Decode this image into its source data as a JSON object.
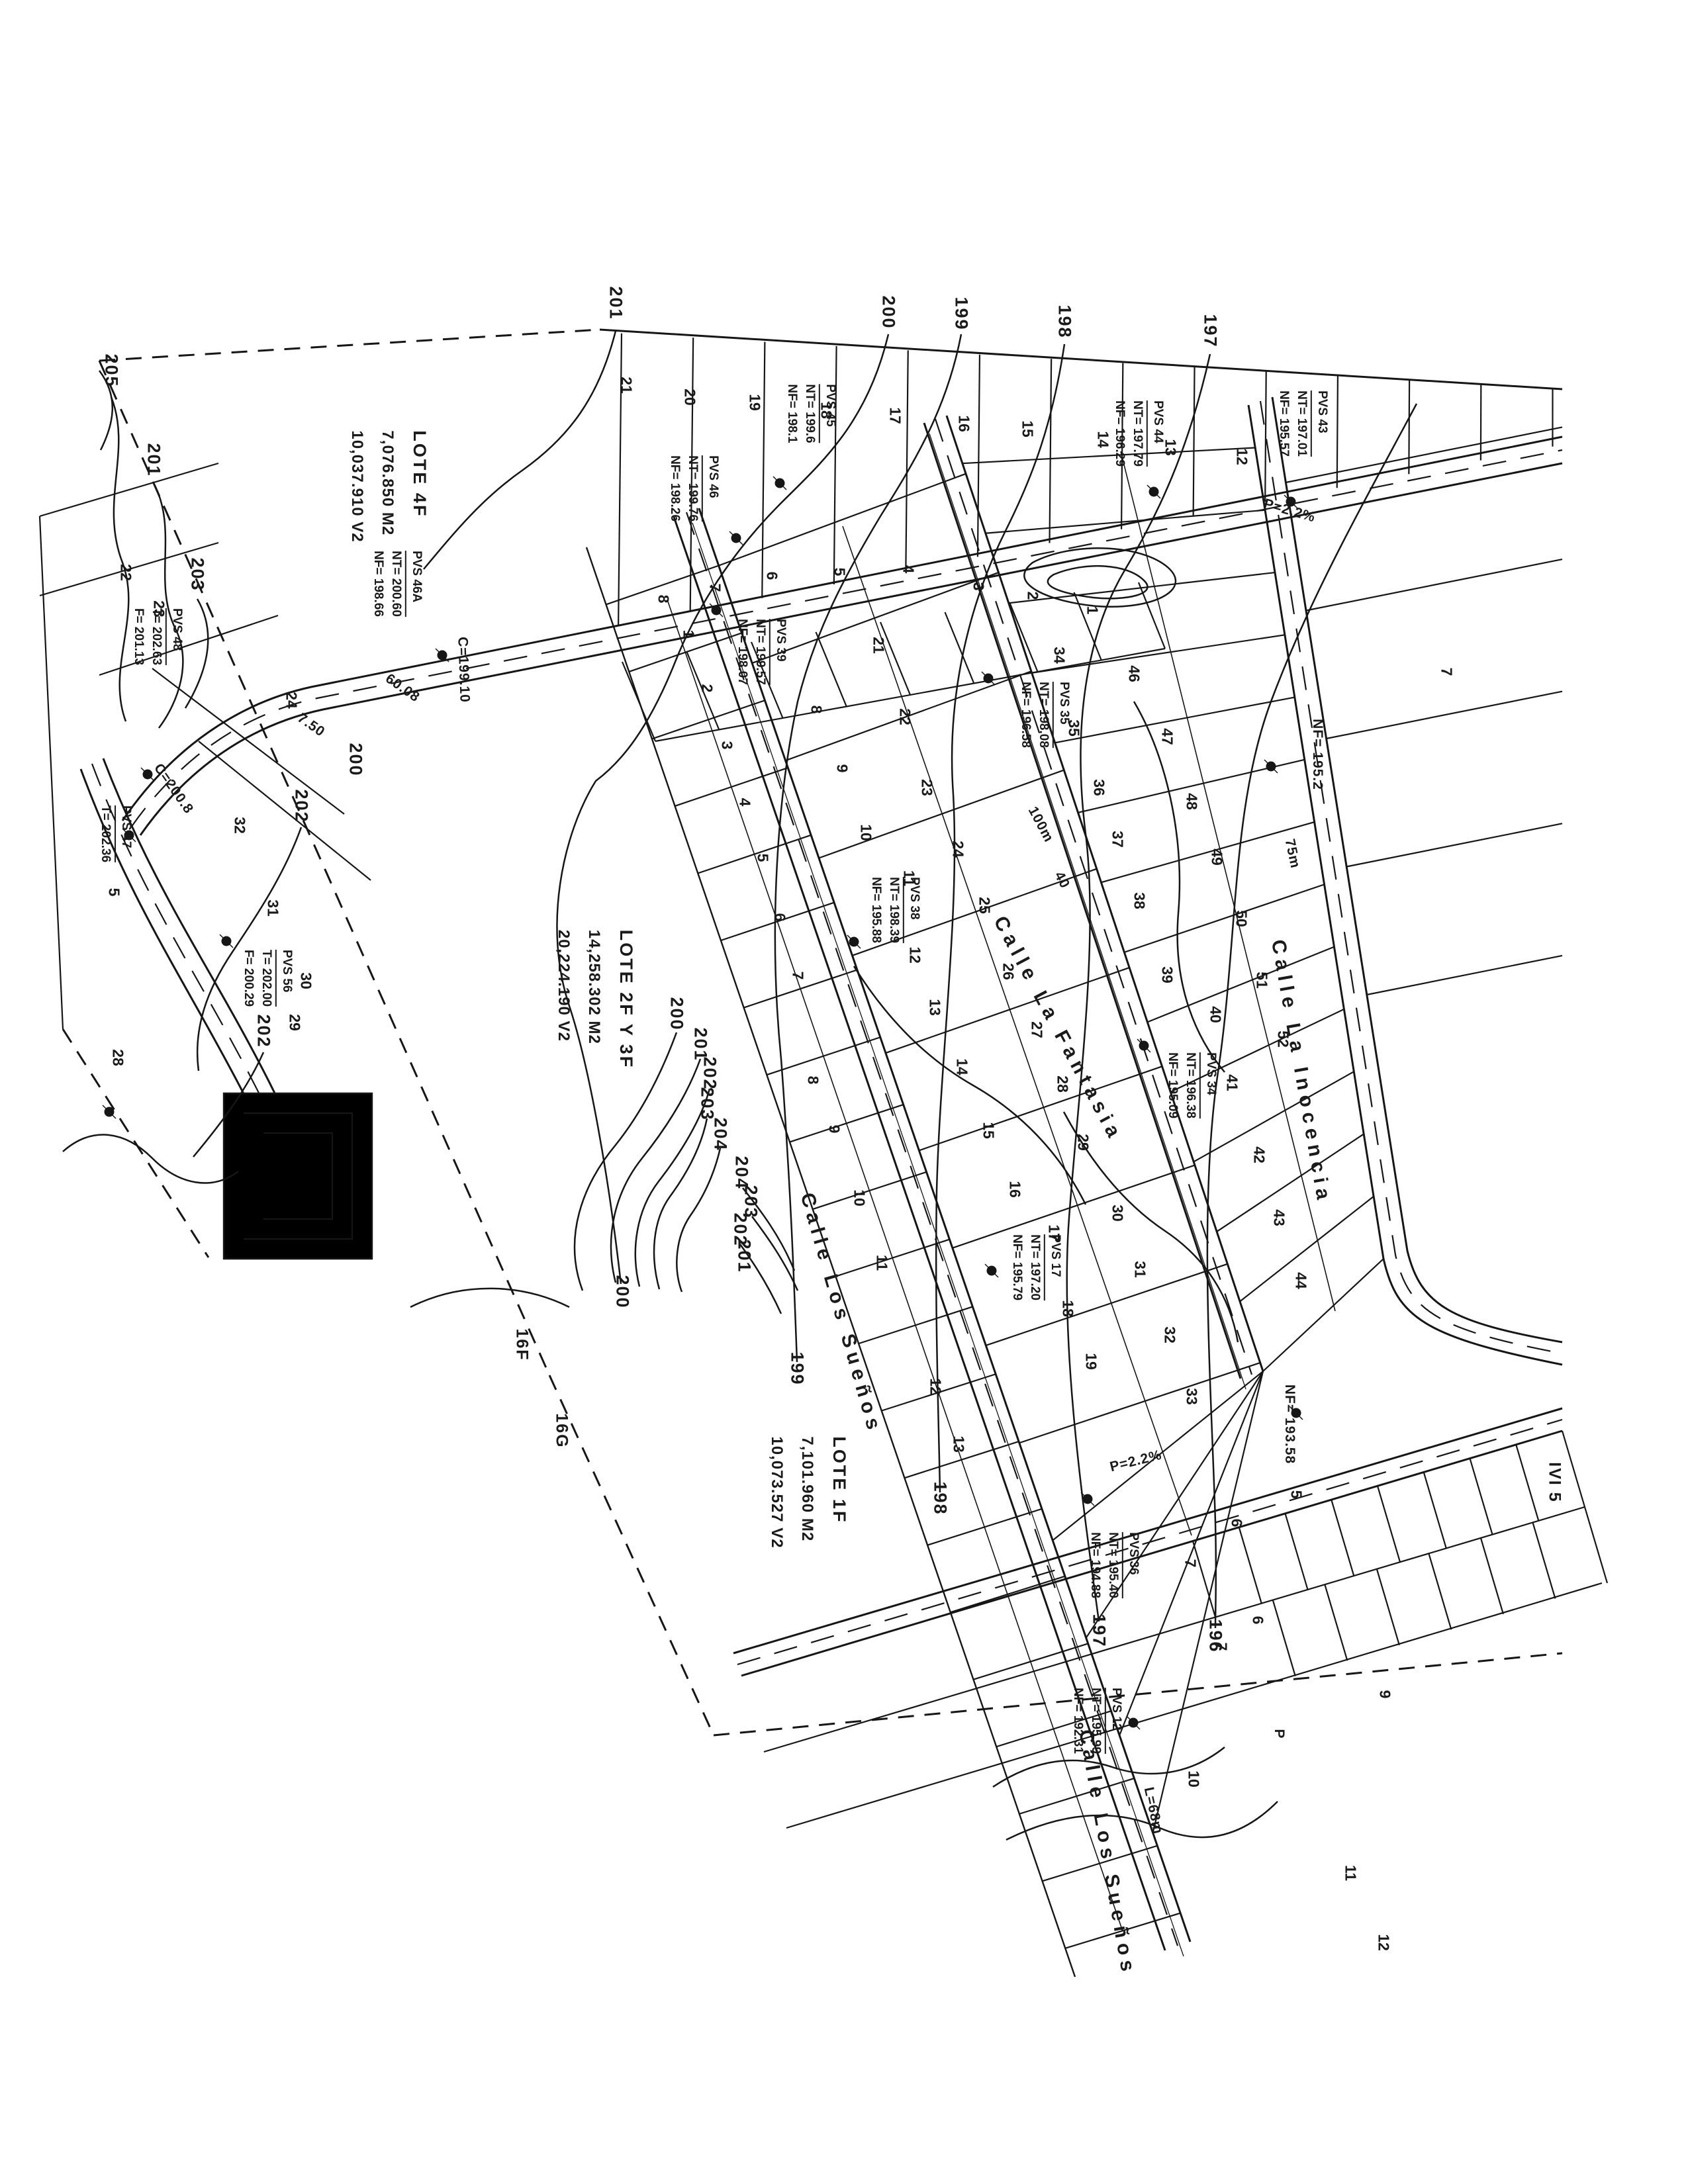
{
  "lote_blocks": [
    {
      "name": "LOTE 4F",
      "area_m2": "7,076.850 M2",
      "area_v2": "10,037.910 V2"
    },
    {
      "name": "LOTE 2F Y 3F",
      "area_m2": "14,258.302 M2",
      "area_v2": "20,224.190 V2"
    },
    {
      "name": "LOTE 1F",
      "area_m2": "7,101.960 M2",
      "area_v2": "10,073.527 V2"
    }
  ],
  "streets": {
    "los_suenos": "Calle Los Sueños",
    "la_fantasia": "Calle La Fantasia",
    "la_inocencia": "Calle La Inocencia"
  },
  "sheet_refs": {
    "ref_16f": "16F",
    "ref_16g": "16G",
    "ref_ivi5": "IVI 5"
  },
  "pvs": [
    {
      "id": "PVS 43",
      "l1": "NT= 197.01",
      "l2": "NF= 195.57"
    },
    {
      "id": "PVS 44",
      "l1": "NT= 197.79",
      "l2": "NF= 196.29"
    },
    {
      "id": "PVS 45",
      "l1": "NT= 199.6",
      "l2": "NF= 198.1"
    },
    {
      "id": "PVS 46",
      "l1": "NT= 199.76",
      "l2": "NF= 198.26"
    },
    {
      "id": "PVS 46A",
      "l1": "NT= 200.60",
      "l2": "NF= 198.66"
    },
    {
      "id": "PVS 48",
      "l1": "T= 202.63",
      "l2": "F= 201.13"
    },
    {
      "id": "PVS 47",
      "l1": "T= 202.36",
      "l2": ""
    },
    {
      "id": "PVS 56",
      "l1": "T= 202.00",
      "l2": "F= 200.29"
    },
    {
      "id": "PVS 39",
      "l1": "NT= 199.57",
      "l2": "NF= 198.07"
    },
    {
      "id": "PVS 35",
      "l1": "NT= 198.08",
      "l2": "NF= 196.58"
    },
    {
      "id": "PVS 38",
      "l1": "NT= 198.39",
      "l2": "NF= 195.88"
    },
    {
      "id": "PVS 17",
      "l1": "NT= 197.20",
      "l2": "NF= 195.79"
    },
    {
      "id": "PVS 34",
      "l1": "NT= 196.38",
      "l2": "NF= 195.09"
    },
    {
      "id": "PVS 36",
      "l1": "NT= 195.40",
      "l2": "NF= 194.88"
    },
    {
      "id": "PVS 12",
      "l1": "NT= 195.99",
      "l2": "NF= 192.31"
    }
  ],
  "contour_labels": [
    "205",
    "201",
    "203",
    "202",
    "202",
    "201",
    "200",
    "199",
    "198",
    "197",
    "200",
    "200",
    "201",
    "202",
    "203",
    "204",
    "204",
    "203",
    "202",
    "201",
    "200",
    "199",
    "198",
    "197",
    "196"
  ],
  "lot_numbers": [
    "21",
    "20",
    "19",
    "18",
    "17",
    "16",
    "15",
    "14",
    "13",
    "12",
    "8",
    "7",
    "6",
    "5",
    "4",
    "3",
    "2",
    "1",
    "1",
    "2",
    "3",
    "4",
    "5",
    "6",
    "7",
    "8",
    "9",
    "10",
    "11",
    "12",
    "13",
    "8",
    "9",
    "10",
    "11",
    "12",
    "13",
    "14",
    "15",
    "16",
    "17",
    "18",
    "19",
    "21",
    "22",
    "23",
    "24",
    "25",
    "26",
    "27",
    "28",
    "29",
    "30",
    "31",
    "32",
    "33",
    "34",
    "35",
    "36",
    "37",
    "38",
    "39",
    "40",
    "41",
    "42",
    "43",
    "44",
    "46",
    "47",
    "48",
    "49",
    "50",
    "51",
    "52",
    "7",
    "5",
    "6",
    "7",
    "6",
    "7",
    "9",
    "10",
    "11",
    "12",
    "22",
    "23",
    "24",
    "5",
    "32",
    "31",
    "30",
    "29",
    "28"
  ],
  "annotations": [
    "C=199.10",
    "60.08",
    "7.50",
    "C=200.8",
    "100m",
    "40",
    "P=2.2%",
    "P=2.2%",
    "L=68m",
    "75m",
    "NF= 193.58",
    "NF= 195.2",
    "P"
  ],
  "colors": {
    "ink": "#161616",
    "paper": "#ffffff"
  }
}
